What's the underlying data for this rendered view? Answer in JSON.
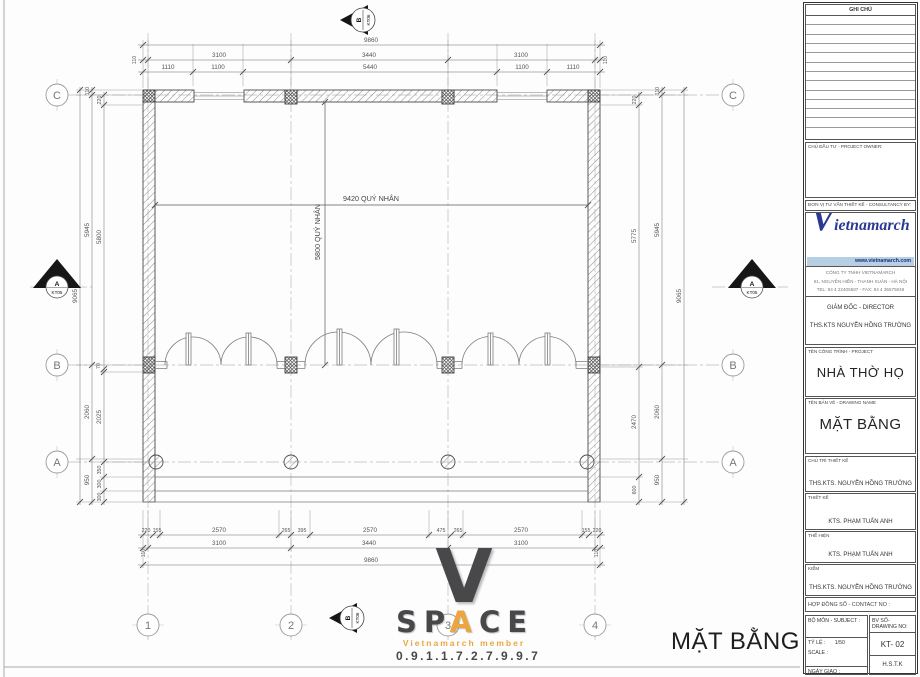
{
  "plan": {
    "caption": "MẶT BẰNG",
    "interior_dim_h": "9420 QUÝ NHÂN",
    "interior_dim_v": "5800 QUÝ NHÂN",
    "grid_rows": [
      "C",
      "B",
      "A"
    ],
    "grid_cols": [
      "1",
      "2",
      "3",
      "4"
    ],
    "sections": {
      "vertical_label": "B",
      "vertical_ref": "KT06",
      "horizontal_label": "A",
      "horizontal_ref": "KT05"
    },
    "dims": {
      "top_overall": "9860",
      "top_row2": [
        "110",
        "3100",
        "3440",
        "3100",
        "110"
      ],
      "top_row3": [
        "1110",
        "1100",
        "5440",
        "1100",
        "1110"
      ],
      "bottom_row1": [
        "220",
        "155",
        "2570",
        "265",
        "395",
        "2570",
        "475",
        "265",
        "2570",
        "155",
        "220"
      ],
      "bottom_row2": [
        "110",
        "3100",
        "3440",
        "3100",
        "110"
      ],
      "bottom_overall": "9860",
      "left_overall": "9065",
      "left_outer": [
        "110",
        "5945",
        "2060",
        "950"
      ],
      "left_inner": [
        "220",
        "5800",
        "70",
        "2025",
        "350",
        "300",
        "300"
      ],
      "right_inner": [
        "220",
        "5775",
        "2470",
        "600"
      ],
      "right_outer": [
        "110",
        "5945",
        "2060",
        "950"
      ],
      "right_overall": "9065"
    }
  },
  "space_logo": {
    "initial": "V",
    "letters": [
      "S",
      "P",
      "A",
      "C",
      "E"
    ],
    "member": "Vietnamarch member",
    "phone": "0.9.1.1.7.2.7.9.9.7",
    "accent_color": "#eca63f"
  },
  "titleblock": {
    "notes_header": "GHI CHÚ",
    "owner_label": "CHỦ ĐẦU TƯ - PROJECT OWNER:",
    "consultant_label": "ĐƠN VỊ TƯ VẤN THIẾT KẾ - CONSULTANCY BY:",
    "brand_initial": "V",
    "brand_rest": "ietnamarch",
    "website": "www.vietnamarch.com",
    "brand_color": "#2a3a94",
    "company_line1": "CÔNG TY TNHH VIETNAMARCH",
    "company_line2": "61, NGUYỄN HIỀN - THANH XUÂN - HÀ NỘI",
    "company_line3": "TEL: 84 4 22405587 - FAX: 84 4 35575046",
    "director_label": "GIÁM ĐỐC - DIRECTOR",
    "director_name": "THS.KTS NGUYỄN HỒNG TRƯỜNG",
    "project_label": "TÊN CÔNG TRÌNH - PROJECT",
    "project_name": "NHÀ THỜ HỌ",
    "drawing_label": "TÊN BẢN VẼ - DRAWING NAME",
    "drawing_name": "MẶT BẰNG",
    "lead_label": "CHỦ TRÌ THIẾT KẾ",
    "lead_name": "THS.KTS. NGUYỄN HỒNG TRƯỜNG",
    "design_label": "THIẾT KẾ",
    "design_name": "KTS. PHẠM TUẤN ANH",
    "draft_label": "THỂ HIỆN",
    "draft_name": "KTS. PHẠM TUẤN ANH",
    "check_label": "KIỂM",
    "check_name": "THS.KTS. NGUYỄN HỒNG TRƯỜNG",
    "contract_label": "HỢP ĐỒNG SỐ - CONTACT NO :",
    "subject_label": "BỘ MÔN - SUBJECT :",
    "drawing_no_label": "BV SỐ-DRAWING NO:",
    "scale_label1": "TỶ LỆ :",
    "scale_value": "1/50",
    "scale_label2": "SCALE :",
    "drawing_no": "KT- 02",
    "issue_label1": "NGÀY GIAO :",
    "issue_label2": "ISSUE DATE :",
    "issue_value": "H.S.T.K"
  }
}
